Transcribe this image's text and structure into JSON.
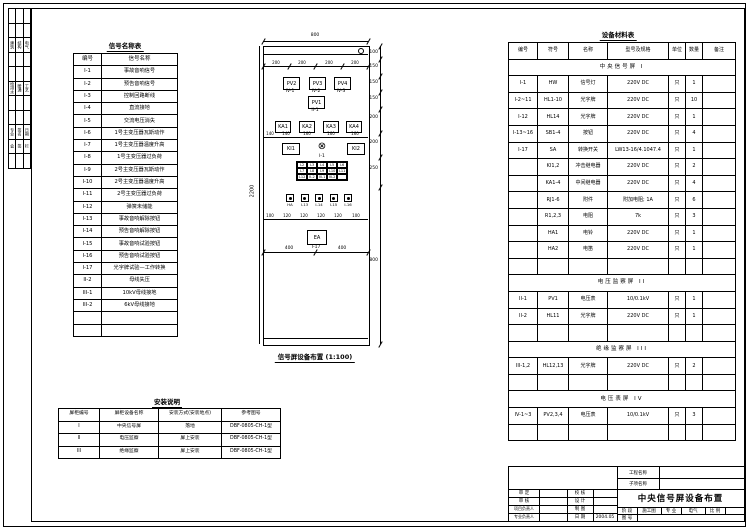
{
  "titles": {
    "left_table": "信号名称表",
    "right_table": "设备材料表",
    "bottom_table": "安装说明",
    "panel_caption": "信号屏设备布置 (1:100)"
  },
  "left_table": {
    "headers": [
      "编号",
      "信号名称"
    ],
    "rows": [
      [
        "I-1",
        "事故音响信号"
      ],
      [
        "I-2",
        "预告音响信号"
      ],
      [
        "I-3",
        "控制回路断线"
      ],
      [
        "I-4",
        "直流接地"
      ],
      [
        "I-5",
        "交流电压消失"
      ],
      [
        "I-6",
        "1号主变压器瓦斯动作"
      ],
      [
        "I-7",
        "1号主变压器温度升高"
      ],
      [
        "I-8",
        "1号主变压器过负荷"
      ],
      [
        "I-9",
        "2号主变压器瓦斯动作"
      ],
      [
        "I-10",
        "2号主变压器温度升高"
      ],
      [
        "I-11",
        "2号主变压器过负荷"
      ],
      [
        "I-12",
        "弹簧未储能"
      ],
      [
        "I-13",
        "事故音响解除按钮"
      ],
      [
        "I-14",
        "预告音响解除按钮"
      ],
      [
        "I-15",
        "事故音响试验按钮"
      ],
      [
        "I-16",
        "预告音响试验按钮"
      ],
      [
        "I-17",
        "光字牌试验—工作转换"
      ],
      [
        "II-2",
        "母线失压"
      ],
      [
        "III-1",
        "10kV母线接地"
      ],
      [
        "III-2",
        "6kV母线接地"
      ],
      [
        "",
        ""
      ],
      [
        "",
        ""
      ]
    ]
  },
  "right_table": {
    "headers": [
      "编号",
      "符号",
      "名称",
      "型号及规格",
      "单位",
      "数量",
      "备注"
    ],
    "rows": [
      {
        "section": "中央信号屏 I"
      },
      [
        "I-1",
        "HW",
        "信号灯",
        "220V DC",
        "只",
        "1",
        ""
      ],
      [
        "I-2~11",
        "HL1-10",
        "光字牌",
        "220V DC",
        "只",
        "10",
        ""
      ],
      [
        "I-12",
        "HL14",
        "光字牌",
        "220V DC",
        "只",
        "1",
        ""
      ],
      [
        "I-13~16",
        "SB1-4",
        "按钮",
        "220V DC",
        "只",
        "4",
        ""
      ],
      [
        "I-17",
        "SA",
        "转换开关",
        "LW13-16/4.1047.4",
        "只",
        "1",
        ""
      ],
      [
        "",
        "KI1,2",
        "冲击继电器",
        "220V DC",
        "只",
        "2",
        ""
      ],
      [
        "",
        "KA1-4",
        "中间继电器",
        "220V DC",
        "只",
        "4",
        ""
      ],
      [
        "",
        "RJ1-6",
        "附件",
        "附加电阻; 1A",
        "只",
        "6",
        ""
      ],
      [
        "",
        "R1,2,3",
        "电阻",
        "7k",
        "只",
        "3",
        ""
      ],
      [
        "",
        "HA1",
        "电铃",
        "220V DC",
        "只",
        "1",
        ""
      ],
      [
        "",
        "HA2",
        "电笛",
        "220V DC",
        "只",
        "1",
        ""
      ],
      [
        "",
        "",
        "",
        "",
        "",
        "",
        ""
      ],
      {
        "section": "电压监察屏 II"
      },
      [
        "II-1",
        "PV1",
        "电压表",
        "10/0.1kV",
        "只",
        "1",
        ""
      ],
      [
        "II-2",
        "HL11",
        "光字牌",
        "220V DC",
        "只",
        "1",
        ""
      ],
      [
        "",
        "",
        "",
        "",
        "",
        "",
        ""
      ],
      {
        "section": "绝缘监察屏 III"
      },
      [
        "III-1,2",
        "HL12,13",
        "光字牌",
        "220V DC",
        "只",
        "2",
        ""
      ],
      [
        "",
        "",
        "",
        "",
        "",
        "",
        ""
      ],
      {
        "section": "电压表屏 IV"
      },
      [
        "IV-1~3",
        "PV2,3,4",
        "电压表",
        "10/0.1kV",
        "只",
        "3",
        ""
      ],
      [
        "",
        "",
        "",
        "",
        "",
        "",
        ""
      ]
    ]
  },
  "bottom_table": {
    "headers": [
      "屏柜编号",
      "屏柜设备名称",
      "安装方式(安装地点)",
      "参考图号"
    ],
    "rows": [
      [
        "I",
        "中央信号屏",
        "落地",
        "DBF-0805-CH-1型"
      ],
      [
        "II",
        "电压监察",
        "屏上安装",
        "DBF-0805-CH-1型"
      ],
      [
        "III",
        "绝缘监察",
        "屏上安装",
        "DBF-0805-CH-1型"
      ]
    ]
  },
  "signoff": {
    "rows": [
      [
        "",
        "",
        ""
      ],
      [
        "",
        "",
        ""
      ],
      [
        "建筑",
        "结构",
        "电气"
      ],
      [
        "",
        "",
        ""
      ],
      [
        "",
        "",
        ""
      ],
      [
        "给排水",
        "暖通",
        "工艺"
      ],
      [
        "",
        "",
        ""
      ],
      [
        "",
        "",
        ""
      ],
      [
        "专业",
        "签名",
        "日期"
      ],
      [
        "会",
        "签",
        "栏"
      ],
      [
        "",
        "",
        ""
      ]
    ]
  },
  "panel": {
    "dim_width": "800",
    "dims_row1": [
      "200",
      "200",
      "200",
      "200"
    ],
    "meters": [
      {
        "label": "PV2",
        "sub": "IV-1"
      },
      {
        "label": "PV3",
        "sub": "IV-2"
      },
      {
        "label": "PV4",
        "sub": "IV-3"
      }
    ],
    "meter_main": {
      "label": "PV1",
      "sub": "II-1"
    },
    "relays": [
      "KA1",
      "KA2",
      "KA3",
      "KA4"
    ],
    "dims_row2": [
      "140",
      "140",
      "160",
      "160",
      "160"
    ],
    "impulse_left": "KI1",
    "impulse_right": "KI2",
    "lamp_symbol": "⊗",
    "lamp_sub": "I-1",
    "plates": [
      "I-2",
      "I-3",
      "I-4",
      "I-5",
      "I-6",
      "I-7",
      "I-8",
      "I-9",
      "I-10",
      "I-11",
      "I-12",
      "II-2",
      "III-1",
      "III-2",
      ""
    ],
    "buttons": [
      "HA",
      "I-13",
      "I-14",
      "I-15",
      "I-16"
    ],
    "dims_row3": [
      "100",
      "120",
      "120",
      "120",
      "120",
      "100"
    ],
    "bell": {
      "label": "EA",
      "sub": "I-17"
    },
    "dims_row4": [
      "400",
      "400"
    ],
    "dim_height": "2200",
    "dims_right": [
      "100",
      "150",
      "150",
      "150",
      "200",
      "200",
      "250",
      "800"
    ],
    "caption": "信号屏设备布置 (1:100)"
  },
  "titleblock": {
    "project_label": "工程名称",
    "subproject_label": "子项名称",
    "approve_label": "审 定",
    "review_label": "审 核",
    "pm_label": "项目负责人",
    "lead_label": "专业负责人",
    "check_label": "校 核",
    "design_label": "设 计",
    "draft_label": "制 图",
    "date_label": "日 期",
    "date_value": "2004.05",
    "drawing_title": "中央信号屏设备布置",
    "stage_label": "阶 段",
    "stage_value": "施工图",
    "major_label": "专 业",
    "major_value": "电气",
    "scale_label": "比 例",
    "dwgno_label": "图 号"
  }
}
